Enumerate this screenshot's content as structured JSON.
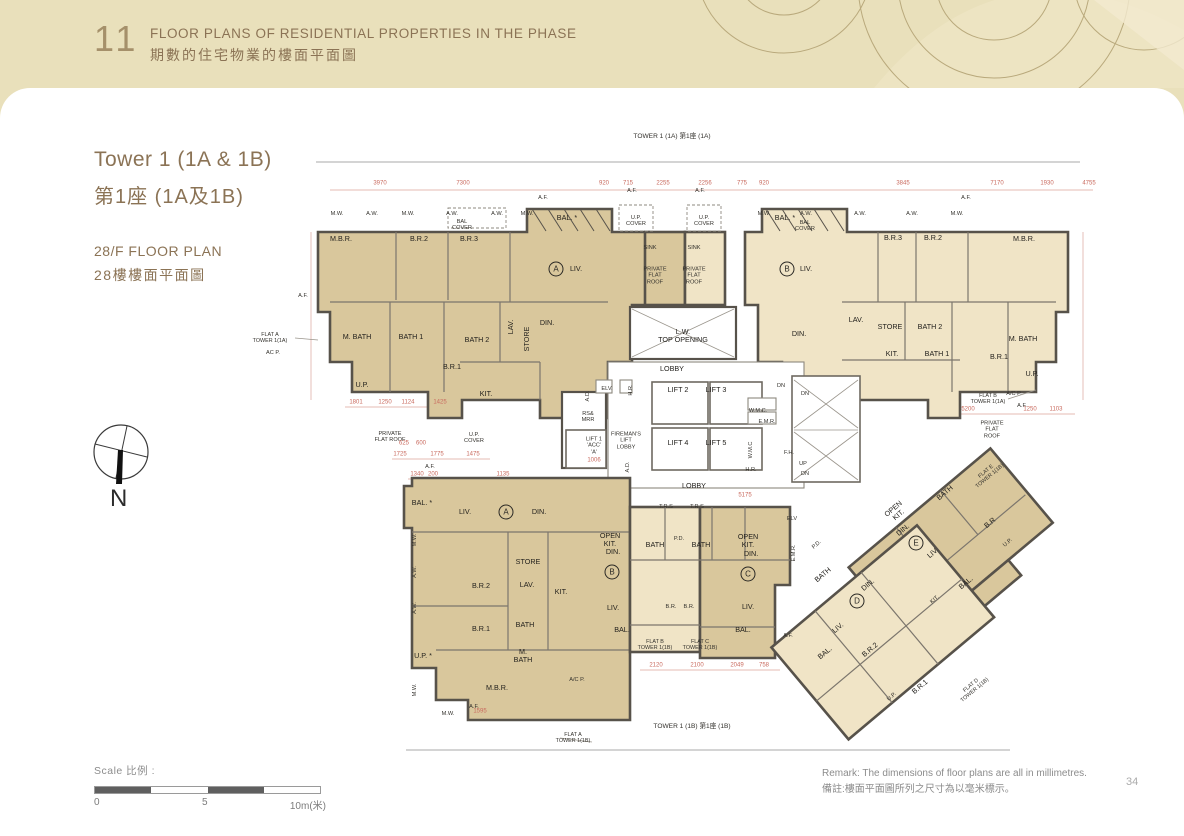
{
  "header": {
    "section_number": "11",
    "title_en": "FLOOR PLANS OF RESIDENTIAL PROPERTIES IN THE PHASE",
    "title_zh": "期數的住宅物業的樓面平面圖"
  },
  "sidebar": {
    "tower_title_en": "Tower 1 (1A & 1B)",
    "tower_title_zh": "第1座 (1A及1B)",
    "floor_en": "28/F FLOOR PLAN",
    "floor_zh": "28樓樓面平面圖",
    "compass_label": "N"
  },
  "plan": {
    "tower_top": "TOWER 1 (1A)\n第1座 (1A)",
    "tower_bottom": "TOWER 1 (1B)\n第1座 (1B)",
    "markers": [
      {
        "t": "A",
        "x": 556,
        "y": 269
      },
      {
        "t": "B",
        "x": 787,
        "y": 269
      },
      {
        "t": "A",
        "x": 506,
        "y": 512
      },
      {
        "t": "B",
        "x": 612,
        "y": 572
      },
      {
        "t": "C",
        "x": 748,
        "y": 574
      },
      {
        "t": "D",
        "x": 857,
        "y": 601
      },
      {
        "t": "E",
        "x": 916,
        "y": 543
      }
    ],
    "labels": [
      {
        "t": "M.B.R.",
        "x": 341,
        "y": 239
      },
      {
        "t": "B.R.2",
        "x": 419,
        "y": 239
      },
      {
        "t": "B.R.3",
        "x": 469,
        "y": 239
      },
      {
        "t": "BAL. *",
        "x": 567,
        "y": 218
      },
      {
        "t": "LIV.",
        "x": 576,
        "y": 269
      },
      {
        "t": "DIN.",
        "x": 547,
        "y": 323
      },
      {
        "t": "M. BATH",
        "x": 357,
        "y": 337
      },
      {
        "t": "BATH 1",
        "x": 411,
        "y": 337
      },
      {
        "t": "BATH 2",
        "x": 477,
        "y": 340
      },
      {
        "t": "LAV.",
        "x": 511,
        "y": 327,
        "r": -90
      },
      {
        "t": "STORE",
        "x": 527,
        "y": 339,
        "r": -90
      },
      {
        "t": "B.R.1",
        "x": 452,
        "y": 367
      },
      {
        "t": "KIT.",
        "x": 486,
        "y": 394
      },
      {
        "t": "U.P.",
        "x": 362,
        "y": 385
      },
      {
        "t": "BAL. *",
        "x": 785,
        "y": 218
      },
      {
        "t": "LIV.",
        "x": 806,
        "y": 269
      },
      {
        "t": "B.R.3",
        "x": 893,
        "y": 238
      },
      {
        "t": "B.R.2",
        "x": 933,
        "y": 238
      },
      {
        "t": "M.B.R.",
        "x": 1024,
        "y": 239
      },
      {
        "t": "DIN.",
        "x": 799,
        "y": 334
      },
      {
        "t": "LAV.",
        "x": 856,
        "y": 320
      },
      {
        "t": "STORE",
        "x": 890,
        "y": 327
      },
      {
        "t": "BATH 2",
        "x": 930,
        "y": 327
      },
      {
        "t": "KIT.",
        "x": 892,
        "y": 354
      },
      {
        "t": "BATH 1",
        "x": 937,
        "y": 354
      },
      {
        "t": "M. BATH",
        "x": 1023,
        "y": 339
      },
      {
        "t": "B.R.1",
        "x": 999,
        "y": 357
      },
      {
        "t": "U.P.",
        "x": 1032,
        "y": 374
      },
      {
        "t": "U.P.\nCOVER",
        "x": 636,
        "y": 221,
        "c": "t"
      },
      {
        "t": "U.P.\nCOVER",
        "x": 704,
        "y": 221,
        "c": "t"
      },
      {
        "t": "SINK",
        "x": 650,
        "y": 248,
        "c": "t"
      },
      {
        "t": "SINK",
        "x": 694,
        "y": 248,
        "c": "t"
      },
      {
        "t": "PRIVATE\nFLAT\nROOF",
        "x": 655,
        "y": 276,
        "c": "t"
      },
      {
        "t": "PRIVATE\nFLAT\nROOF",
        "x": 694,
        "y": 276,
        "c": "t"
      },
      {
        "t": "L.W.\nTOP OPENING",
        "x": 683,
        "y": 336
      },
      {
        "t": "LOBBY",
        "x": 672,
        "y": 369
      },
      {
        "t": "LIFT 2",
        "x": 678,
        "y": 390
      },
      {
        "t": "LIFT 3",
        "x": 716,
        "y": 390
      },
      {
        "t": "LIFT 4",
        "x": 678,
        "y": 443
      },
      {
        "t": "LIFT 5",
        "x": 716,
        "y": 443
      },
      {
        "t": "W.M.C.",
        "x": 758,
        "y": 411,
        "c": "t"
      },
      {
        "t": "E.M.R.",
        "x": 767,
        "y": 422,
        "c": "t"
      },
      {
        "t": "W.M.C",
        "x": 751,
        "y": 450,
        "c": "t",
        "r": -90
      },
      {
        "t": "H.R.",
        "x": 751,
        "y": 470,
        "c": "t"
      },
      {
        "t": "F.H.",
        "x": 789,
        "y": 453,
        "c": "t"
      },
      {
        "t": "UP",
        "x": 803,
        "y": 464,
        "c": "t"
      },
      {
        "t": "DN",
        "x": 805,
        "y": 474,
        "c": "t"
      },
      {
        "t": "DN",
        "x": 781,
        "y": 386,
        "c": "t"
      },
      {
        "t": "DN",
        "x": 805,
        "y": 394,
        "c": "t"
      },
      {
        "t": "LOBBY",
        "x": 694,
        "y": 486
      },
      {
        "t": "FIREMAN'S\nLIFT\nLOBBY",
        "x": 626,
        "y": 441,
        "c": "t"
      },
      {
        "t": "LIFT 1\n'ACC'\n'A'",
        "x": 594,
        "y": 446,
        "c": "t"
      },
      {
        "t": "RS&\nMRR",
        "x": 588,
        "y": 417,
        "c": "t"
      },
      {
        "t": "ELV.",
        "x": 607,
        "y": 389,
        "c": "t"
      },
      {
        "t": "H.R.",
        "x": 631,
        "y": 390,
        "c": "t",
        "r": -90
      },
      {
        "t": "A.D.",
        "x": 588,
        "y": 396,
        "c": "t",
        "r": -90
      },
      {
        "t": "A.D.",
        "x": 628,
        "y": 467,
        "c": "t",
        "r": -90
      },
      {
        "t": "ELV",
        "x": 792,
        "y": 519,
        "c": "t"
      },
      {
        "t": "E.M.R.",
        "x": 794,
        "y": 553,
        "c": "t",
        "r": -90
      },
      {
        "t": "FLAT A\nTOWER 1(1A)",
        "x": 270,
        "y": 338,
        "c": "fr"
      },
      {
        "t": "AC P.",
        "x": 273,
        "y": 353,
        "c": "t"
      },
      {
        "t": "PRIVATE\nFLAT ROOF",
        "x": 390,
        "y": 437,
        "c": "t"
      },
      {
        "t": "U.P.\nCOVER",
        "x": 474,
        "y": 438,
        "c": "t"
      },
      {
        "t": "BAL\nCOVER",
        "x": 462,
        "y": 225,
        "c": "t"
      },
      {
        "t": "BAL\nCOVER",
        "x": 805,
        "y": 226,
        "c": "t"
      },
      {
        "t": "FLAT B\nTOWER 1(1A)",
        "x": 988,
        "y": 399,
        "c": "fr"
      },
      {
        "t": "A/C P.",
        "x": 1014,
        "y": 394,
        "c": "t"
      },
      {
        "t": "A.F.",
        "x": 1022,
        "y": 406,
        "c": "t"
      },
      {
        "t": "PRIVATE\nFLAT\nROOF",
        "x": 992,
        "y": 430,
        "c": "t"
      },
      {
        "t": "FLAT E\nTOWER 1(1B)",
        "x": 988,
        "y": 474,
        "c": "fr",
        "r": -40
      },
      {
        "t": "FLAT A\nTOWER 1(1B)",
        "x": 573,
        "y": 738,
        "c": "fr"
      },
      {
        "t": "FLAT B\nTOWER 1(1B)",
        "x": 655,
        "y": 645,
        "c": "fr"
      },
      {
        "t": "FLAT C\nTOWER 1(1B)",
        "x": 700,
        "y": 645,
        "c": "fr"
      },
      {
        "t": "FLAT D\nTOWER 1(1B)",
        "x": 973,
        "y": 688,
        "c": "fr",
        "r": -40
      },
      {
        "t": "BAL. *",
        "x": 422,
        "y": 503
      },
      {
        "t": "LIV.",
        "x": 465,
        "y": 512
      },
      {
        "t": "DIN.",
        "x": 539,
        "y": 512
      },
      {
        "t": "STORE",
        "x": 528,
        "y": 562
      },
      {
        "t": "B.R.2",
        "x": 481,
        "y": 586
      },
      {
        "t": "LAV.",
        "x": 527,
        "y": 585
      },
      {
        "t": "KIT.",
        "x": 561,
        "y": 592
      },
      {
        "t": "B.R.1",
        "x": 481,
        "y": 629
      },
      {
        "t": "BATH",
        "x": 525,
        "y": 625
      },
      {
        "t": "M.\nBATH",
        "x": 523,
        "y": 656
      },
      {
        "t": "U.P. *",
        "x": 423,
        "y": 656
      },
      {
        "t": "M.B.R.",
        "x": 497,
        "y": 688
      },
      {
        "t": "A/C P.",
        "x": 577,
        "y": 680,
        "c": "t"
      },
      {
        "t": "T.R.S",
        "x": 666,
        "y": 507,
        "c": "t"
      },
      {
        "t": "T.R.S",
        "x": 697,
        "y": 507,
        "c": "t"
      },
      {
        "t": "BATH",
        "x": 655,
        "y": 545
      },
      {
        "t": "P.D.",
        "x": 679,
        "y": 539,
        "c": "t"
      },
      {
        "t": "BATH",
        "x": 701,
        "y": 545
      },
      {
        "t": "OPEN\nKIT.",
        "x": 610,
        "y": 540
      },
      {
        "t": "DIN.",
        "x": 613,
        "y": 552
      },
      {
        "t": "LIV.",
        "x": 613,
        "y": 608
      },
      {
        "t": "BAL.",
        "x": 622,
        "y": 630
      },
      {
        "t": "B.R.",
        "x": 671,
        "y": 607,
        "c": "t"
      },
      {
        "t": "B.R.",
        "x": 689,
        "y": 607,
        "c": "t"
      },
      {
        "t": "OPEN\nKIT.",
        "x": 748,
        "y": 541
      },
      {
        "t": "DIN.",
        "x": 751,
        "y": 554
      },
      {
        "t": "LIV.",
        "x": 748,
        "y": 607
      },
      {
        "t": "BAL.",
        "x": 743,
        "y": 630
      },
      {
        "t": "OPEN\nKIT.",
        "x": 896,
        "y": 512,
        "r": -40
      },
      {
        "t": "DIN.",
        "x": 903,
        "y": 530,
        "r": -40
      },
      {
        "t": "LIV.",
        "x": 933,
        "y": 553,
        "r": -40
      },
      {
        "t": "BATH",
        "x": 945,
        "y": 493,
        "r": -40
      },
      {
        "t": "B.R",
        "x": 990,
        "y": 523,
        "r": -40
      },
      {
        "t": "U.P.",
        "x": 1008,
        "y": 543,
        "r": -40,
        "c": "t"
      },
      {
        "t": "BAL.",
        "x": 966,
        "y": 583,
        "r": -40
      },
      {
        "t": "KIT.",
        "x": 935,
        "y": 600,
        "r": -40,
        "c": "t"
      },
      {
        "t": "BATH",
        "x": 823,
        "y": 575,
        "r": -40
      },
      {
        "t": "P.D.",
        "x": 817,
        "y": 545,
        "r": -40,
        "c": "t"
      },
      {
        "t": "DIN.",
        "x": 868,
        "y": 585,
        "r": -40
      },
      {
        "t": "LIV.",
        "x": 838,
        "y": 628,
        "r": -40
      },
      {
        "t": "BAL.",
        "x": 825,
        "y": 653,
        "r": -40
      },
      {
        "t": "B.R.2",
        "x": 870,
        "y": 650,
        "r": -40
      },
      {
        "t": "B.R.1",
        "x": 920,
        "y": 687,
        "r": -40
      },
      {
        "t": "U.P.",
        "x": 892,
        "y": 697,
        "r": -40,
        "c": "t"
      },
      {
        "t": "A.F.",
        "x": 543,
        "y": 198,
        "c": "t"
      },
      {
        "t": "A.F.",
        "x": 632,
        "y": 191,
        "c": "t"
      },
      {
        "t": "A.F.",
        "x": 700,
        "y": 191,
        "c": "t"
      },
      {
        "t": "A.F.",
        "x": 966,
        "y": 198,
        "c": "t"
      },
      {
        "t": "M.W.",
        "x": 337,
        "y": 214,
        "c": "t"
      },
      {
        "t": "A.W.",
        "x": 372,
        "y": 214,
        "c": "t"
      },
      {
        "t": "M.W.",
        "x": 408,
        "y": 214,
        "c": "t"
      },
      {
        "t": "A.W.",
        "x": 452,
        "y": 214,
        "c": "t"
      },
      {
        "t": "A.W.",
        "x": 497,
        "y": 214,
        "c": "t"
      },
      {
        "t": "M.W.",
        "x": 527,
        "y": 214,
        "c": "t"
      },
      {
        "t": "M.W.",
        "x": 764,
        "y": 214,
        "c": "t"
      },
      {
        "t": "A.W.",
        "x": 806,
        "y": 214,
        "c": "t"
      },
      {
        "t": "A.W.",
        "x": 860,
        "y": 214,
        "c": "t"
      },
      {
        "t": "A.W.",
        "x": 912,
        "y": 214,
        "c": "t"
      },
      {
        "t": "M.W.",
        "x": 957,
        "y": 214,
        "c": "t"
      },
      {
        "t": "A.F.",
        "x": 430,
        "y": 467,
        "c": "t"
      },
      {
        "t": "A.F.",
        "x": 303,
        "y": 296,
        "c": "t"
      },
      {
        "t": "M.W.",
        "x": 415,
        "y": 540,
        "c": "t",
        "r": -90
      },
      {
        "t": "A.W.",
        "x": 415,
        "y": 572,
        "c": "t",
        "r": -90
      },
      {
        "t": "A.W.",
        "x": 415,
        "y": 608,
        "c": "t",
        "r": -90
      },
      {
        "t": "M.W.",
        "x": 415,
        "y": 690,
        "c": "t",
        "r": -90
      },
      {
        "t": "M.W.",
        "x": 448,
        "y": 714,
        "c": "t"
      },
      {
        "t": "A.F.",
        "x": 474,
        "y": 707,
        "c": "t"
      },
      {
        "t": "A.F.",
        "x": 788,
        "y": 636,
        "c": "t"
      }
    ],
    "dims": [
      {
        "t": "3970",
        "x": 380,
        "y": 184
      },
      {
        "t": "7300",
        "x": 463,
        "y": 184
      },
      {
        "t": "920",
        "x": 604,
        "y": 184
      },
      {
        "t": "715",
        "x": 628,
        "y": 184
      },
      {
        "t": "2255",
        "x": 663,
        "y": 184
      },
      {
        "t": "2256",
        "x": 705,
        "y": 184
      },
      {
        "t": "775",
        "x": 742,
        "y": 184
      },
      {
        "t": "920",
        "x": 764,
        "y": 184
      },
      {
        "t": "3845",
        "x": 903,
        "y": 184
      },
      {
        "t": "7170",
        "x": 997,
        "y": 184
      },
      {
        "t": "1930",
        "x": 1047,
        "y": 184
      },
      {
        "t": "4755",
        "x": 1089,
        "y": 184
      },
      {
        "t": "1801",
        "x": 356,
        "y": 403
      },
      {
        "t": "1250",
        "x": 385,
        "y": 403
      },
      {
        "t": "1124",
        "x": 408,
        "y": 403
      },
      {
        "t": "1425",
        "x": 440,
        "y": 403
      },
      {
        "t": "625",
        "x": 404,
        "y": 444
      },
      {
        "t": "600",
        "x": 421,
        "y": 444
      },
      {
        "t": "1725",
        "x": 400,
        "y": 455
      },
      {
        "t": "1775",
        "x": 437,
        "y": 455
      },
      {
        "t": "1475",
        "x": 473,
        "y": 455
      },
      {
        "t": "1006",
        "x": 594,
        "y": 461
      },
      {
        "t": "5175",
        "x": 745,
        "y": 496
      },
      {
        "t": "5200",
        "x": 968,
        "y": 410
      },
      {
        "t": "1250",
        "x": 1030,
        "y": 410
      },
      {
        "t": "1103",
        "x": 1056,
        "y": 410
      },
      {
        "t": "2120",
        "x": 656,
        "y": 666
      },
      {
        "t": "2100",
        "x": 697,
        "y": 666
      },
      {
        "t": "2049",
        "x": 737,
        "y": 666
      },
      {
        "t": "758",
        "x": 764,
        "y": 666
      },
      {
        "t": "1135",
        "x": 503,
        "y": 475
      },
      {
        "t": "1340",
        "x": 417,
        "y": 475
      },
      {
        "t": "200",
        "x": 433,
        "y": 475
      },
      {
        "t": "1595",
        "x": 480,
        "y": 712
      }
    ]
  },
  "footer": {
    "scale_label": "Scale 比例 :",
    "scale_ticks": [
      "0",
      "5",
      "10m(米)"
    ],
    "remark_en": "Remark: The dimensions of floor plans are all in millimetres.",
    "remark_zh": "備註:樓面平面圖所列之尺寸為以毫米標示。",
    "page_number": "34"
  },
  "colors": {
    "header_bg": "#e9e0bb",
    "accent_brown": "#8b7355",
    "flat_dark": "#d9c79c",
    "flat_light": "#f0e4c6",
    "dim_red": "#c96a5e"
  }
}
